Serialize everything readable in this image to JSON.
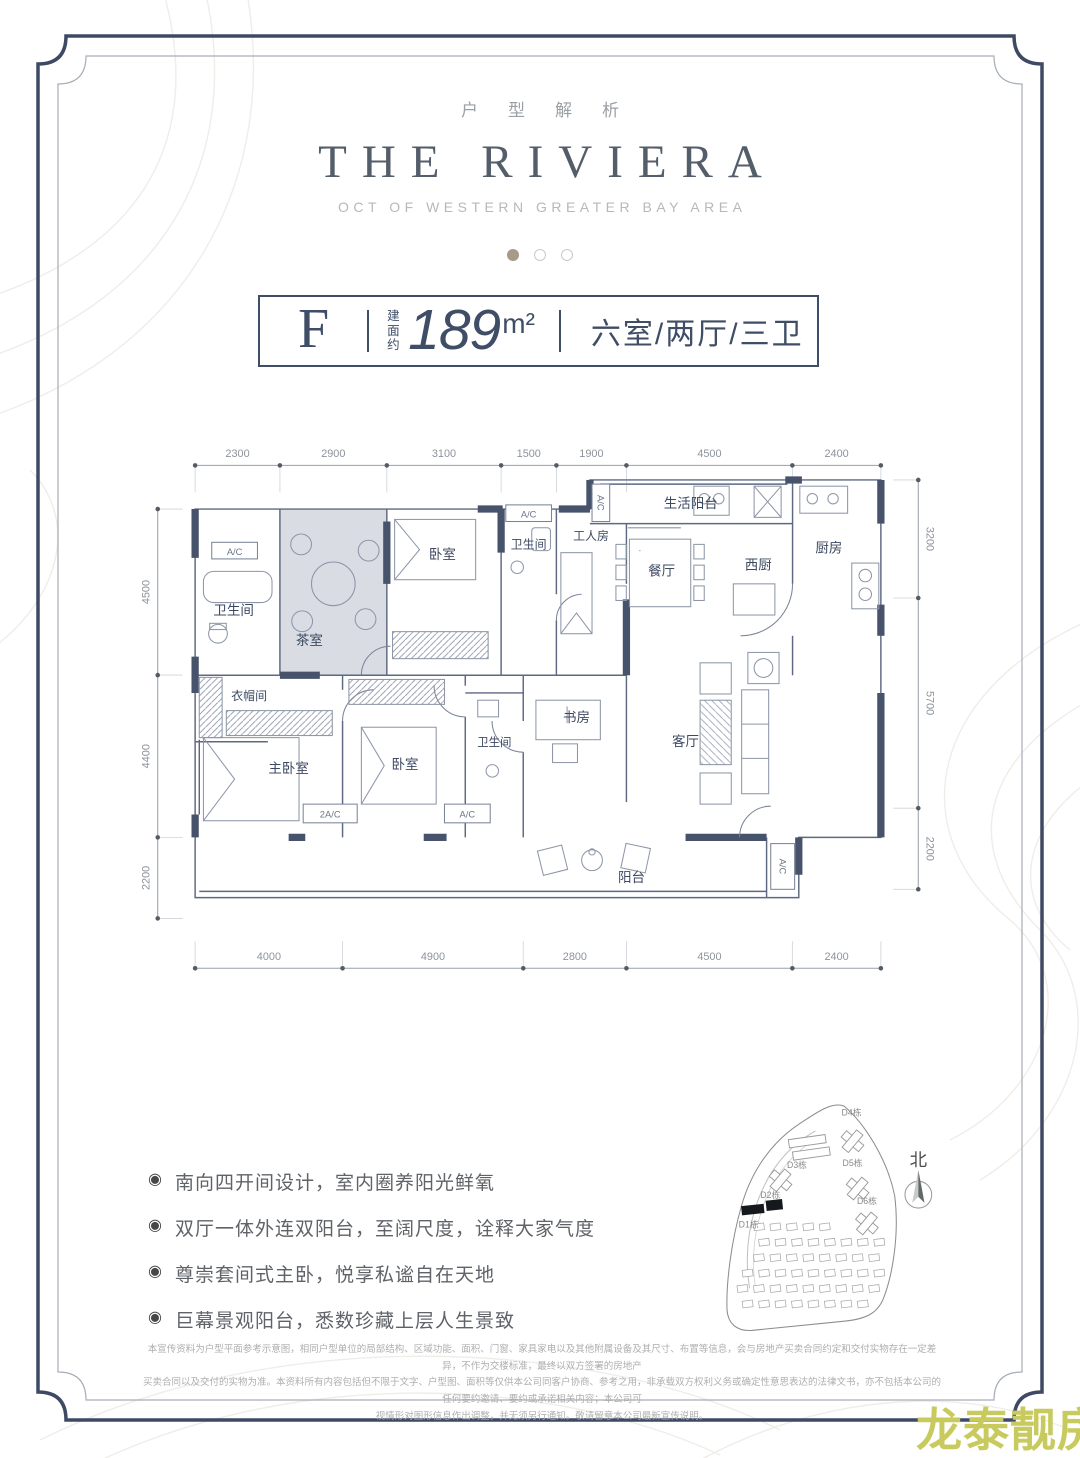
{
  "header": {
    "eyebrow": "户型解析",
    "title": "THE RIVIERA",
    "subtitle": "OCT OF WESTERN GREATER BAY AREA"
  },
  "spec": {
    "type_letter": "F",
    "area_label": "建面约",
    "area_value": "189",
    "area_unit": "m²",
    "rooms_text": "六室/两厅/三卫"
  },
  "floorplan": {
    "dims_top": [
      "2300",
      "2900",
      "3100",
      "1500",
      "1900",
      "4500",
      "2400"
    ],
    "dims_bottom": [
      "4000",
      "4900",
      "2800",
      "4500",
      "2400"
    ],
    "dims_left": [
      "4500",
      "4400",
      "2200"
    ],
    "dims_right": [
      "3200",
      "5700",
      "2200"
    ],
    "rooms": {
      "bath_top": "卫生间",
      "tea_room": "茶室",
      "bedroom_top": "卧室",
      "bath_mid": "卫生间",
      "worker_room": "工人房",
      "laundry_balcony": "生活阳台",
      "dining": "餐厅",
      "west_kitchen": "西厨",
      "kitchen": "厨房",
      "cloakroom": "衣帽间",
      "master_bedroom": "主卧室",
      "bedroom2": "卧室",
      "bath2": "卫生间",
      "study": "书房",
      "living": "客厅",
      "balcony": "阳台"
    },
    "labels": {
      "ac": "A/C",
      "ac2": "2A/C"
    }
  },
  "features": {
    "items": [
      "南向四开间设计，室内圈养阳光鲜氧",
      "双厅一体外连双阳台，至阔尺度，诠释大家气度",
      "尊崇套间式主卧，悦享私谧自在天地",
      "巨幕景观阳台，悉数珍藏上层人生景致"
    ]
  },
  "siteplan": {
    "north": "北",
    "buildings": [
      "D1栋",
      "D2栋",
      "D3栋",
      "D4栋",
      "D5栋",
      "D6栋"
    ]
  },
  "disclaimer": {
    "lines": [
      "本宣传资料为户型平面参考示意图，相同户型单位的局部结构、区域功能、面积、门窗、家具家电以及其他附属设备及其尺寸、布置等信息，会与房地产买卖合同约定和交付实物存在一定差异，不作为交楼标准，最终以双方签署的房地产",
      "买卖合同以及交付的实物为准。本资料所有内容包括但不限于文字、户型图、面积等仅供本公司同客户协商、参考之用，非承载双方权利义务或确定性意思表达的法律文书，亦不包括本公司的任何要约邀请、要约或承诺相关内容；本公司可",
      "视情形对图形信息作出调整，并无须另行通知。敬请留意本公司最新宣传说明。"
    ]
  },
  "watermark": "龙泰靓房",
  "colors": {
    "accent": "#3f4d66",
    "wall": "#47536b",
    "watermark": "#c8ca5e",
    "dot_active": "#a89a89"
  }
}
